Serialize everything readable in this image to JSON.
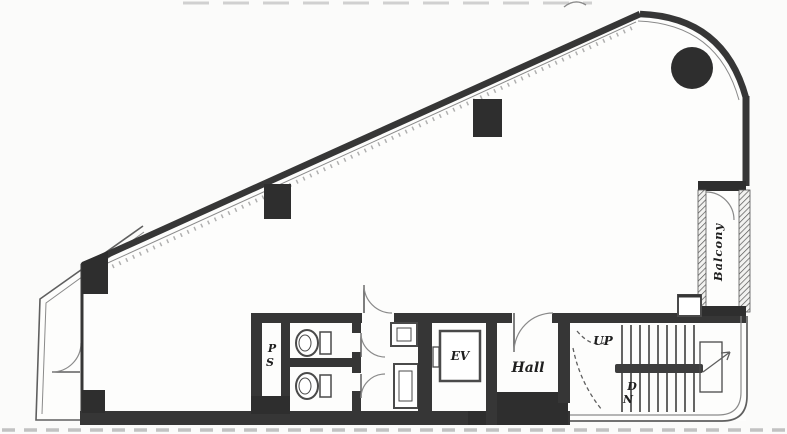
{
  "plan": {
    "labels": {
      "pipe_shaft_top": "P",
      "pipe_shaft_bottom": "S",
      "elevator": "EV",
      "hall": "Hall",
      "stairs_up": "UP",
      "stairs_down_top": "D",
      "stairs_down_bottom": "N",
      "balcony": "Balcony"
    },
    "colors": {
      "wall": "#363636",
      "wallDark": "#2e2e2e",
      "line": "#4a4a4a",
      "thin": "#5f5f5f",
      "faint": "#c2c2c2",
      "paper": "#fbfbfa"
    }
  }
}
